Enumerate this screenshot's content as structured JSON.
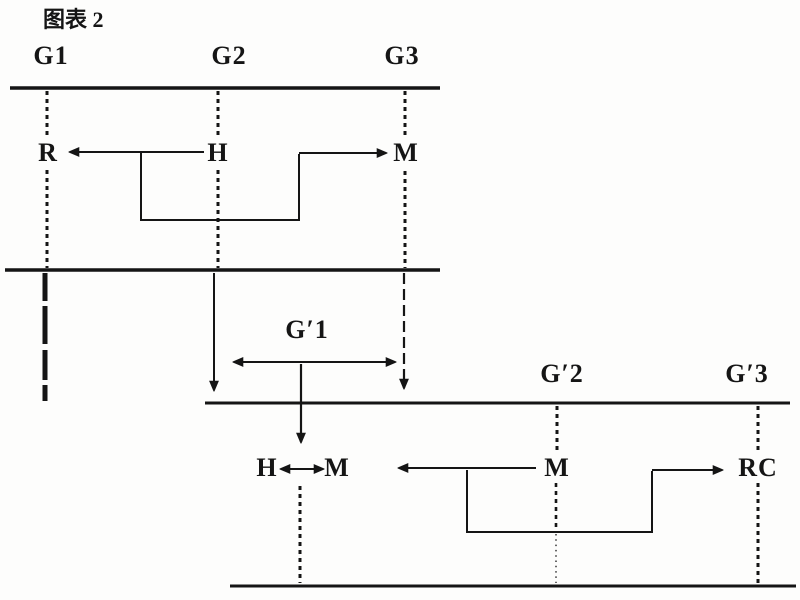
{
  "canvas": {
    "background": "#fdfdfc",
    "ink": "#151515"
  },
  "caption": "图表 2",
  "top_timeline": {
    "generations": [
      "G1",
      "G2",
      "G3"
    ],
    "nodes": {
      "r": "R",
      "h": "H",
      "m": "M"
    }
  },
  "second_timeline": {
    "generations": [
      "G′1",
      "G′2",
      "G′3"
    ],
    "nodes": {
      "h": "H",
      "m_pair": "M",
      "m": "M",
      "rc": "RC"
    }
  }
}
